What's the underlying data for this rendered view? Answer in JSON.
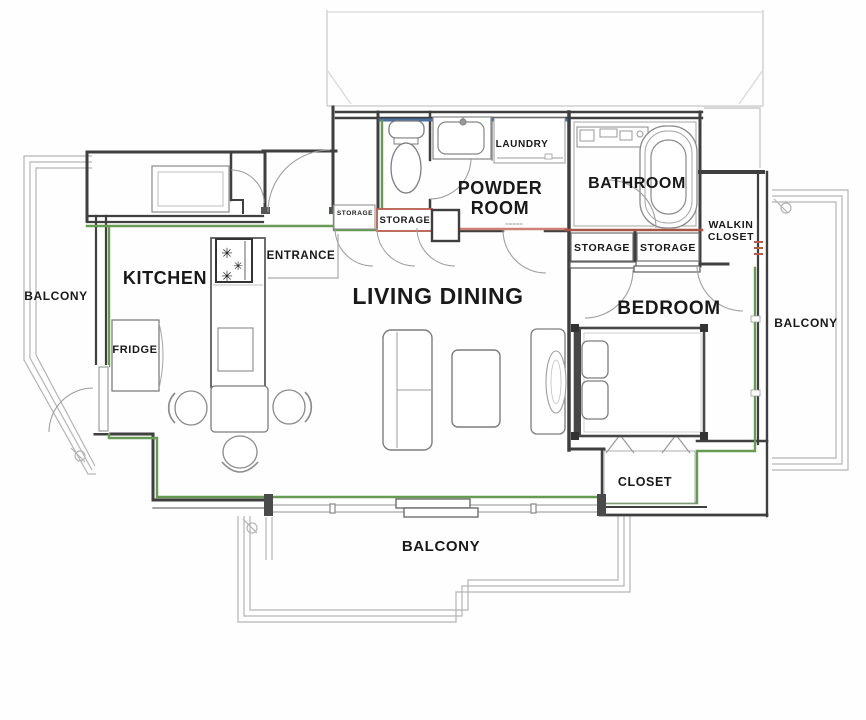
{
  "plan_title": "apartment-floor-plan",
  "labels": {
    "kitchen": "KITCHEN",
    "living_dining": "LIVING DINING",
    "bedroom": "BEDROOM",
    "powder_line1": "POWDER",
    "powder_line2": "ROOM",
    "bathroom": "BATHROOM",
    "laundry": "LAUNDRY",
    "entrance": "ENTRANCE",
    "fridge": "FRIDGE",
    "balcony_left": "BALCONY",
    "balcony_right": "BALCONY",
    "balcony_bottom": "BALCONY",
    "storage_entry_small": "STORAGE",
    "storage_entry": "STORAGE",
    "storage_bedroom_left": "STORAGE",
    "storage_bedroom_right": "STORAGE",
    "walkin_line1": "WALKIN",
    "walkin_line2": "CLOSET",
    "closet": "CLOSET"
  },
  "colors": {
    "wall": "#3f3f3f",
    "window_green": "#679a52",
    "accent_blue": "#4a6fa0",
    "accent_red": "#a85545",
    "accent_salmon": "#cc8274",
    "accent_yellow": "#e2ce3f",
    "balcony_line": "#b4b4b4",
    "label_text": "#191919"
  }
}
